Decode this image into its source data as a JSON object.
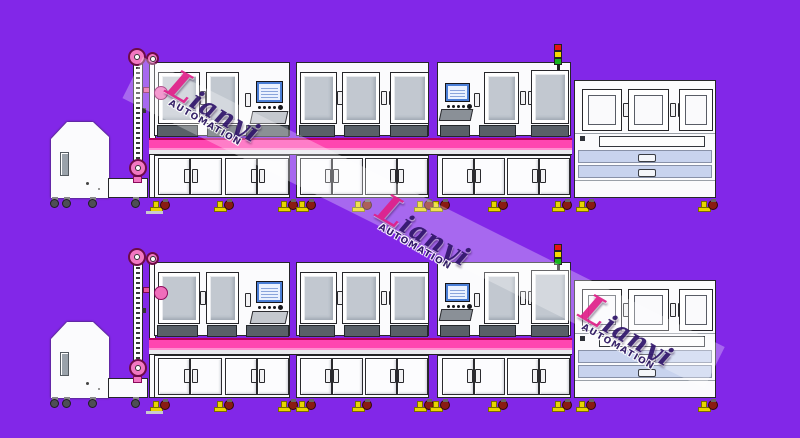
{
  "watermark": {
    "name": "Lianyi",
    "subtitle": "AUTOMATION",
    "instances": 3
  },
  "palette": {
    "bg": "#8227E8",
    "machine_white": "#FBFBFD",
    "outline": "#26262a",
    "glass": "#C2C8D0",
    "dark_panel": "#596068",
    "pink_band": "#FF46B0",
    "pink_band_dark": "#B4005F",
    "pink_band_light": "#FF8FD0",
    "pulley_pink": "#F278C2",
    "drawer": "#C8D3EE",
    "rail": "#E9E9EE",
    "wheel_red": "#8A1B12",
    "foot_yellow": "#E8D500",
    "lamp_red": "#E81313",
    "lamp_yellow": "#F5D800",
    "lamp_green": "#17B51F",
    "hmi_screen_border": "#4A7ED6",
    "hmi_screen_bg": "#EAF1FF",
    "watermark_band": "rgba(255,255,255,0.30)",
    "wm_name_color": "#31166B",
    "wm_first_letter": "#E0218A",
    "wm_sub_color": "#2B1560",
    "dash": "#C9C9CE"
  },
  "lines": [
    {
      "id": "top"
    },
    {
      "id": "bottom"
    }
  ]
}
